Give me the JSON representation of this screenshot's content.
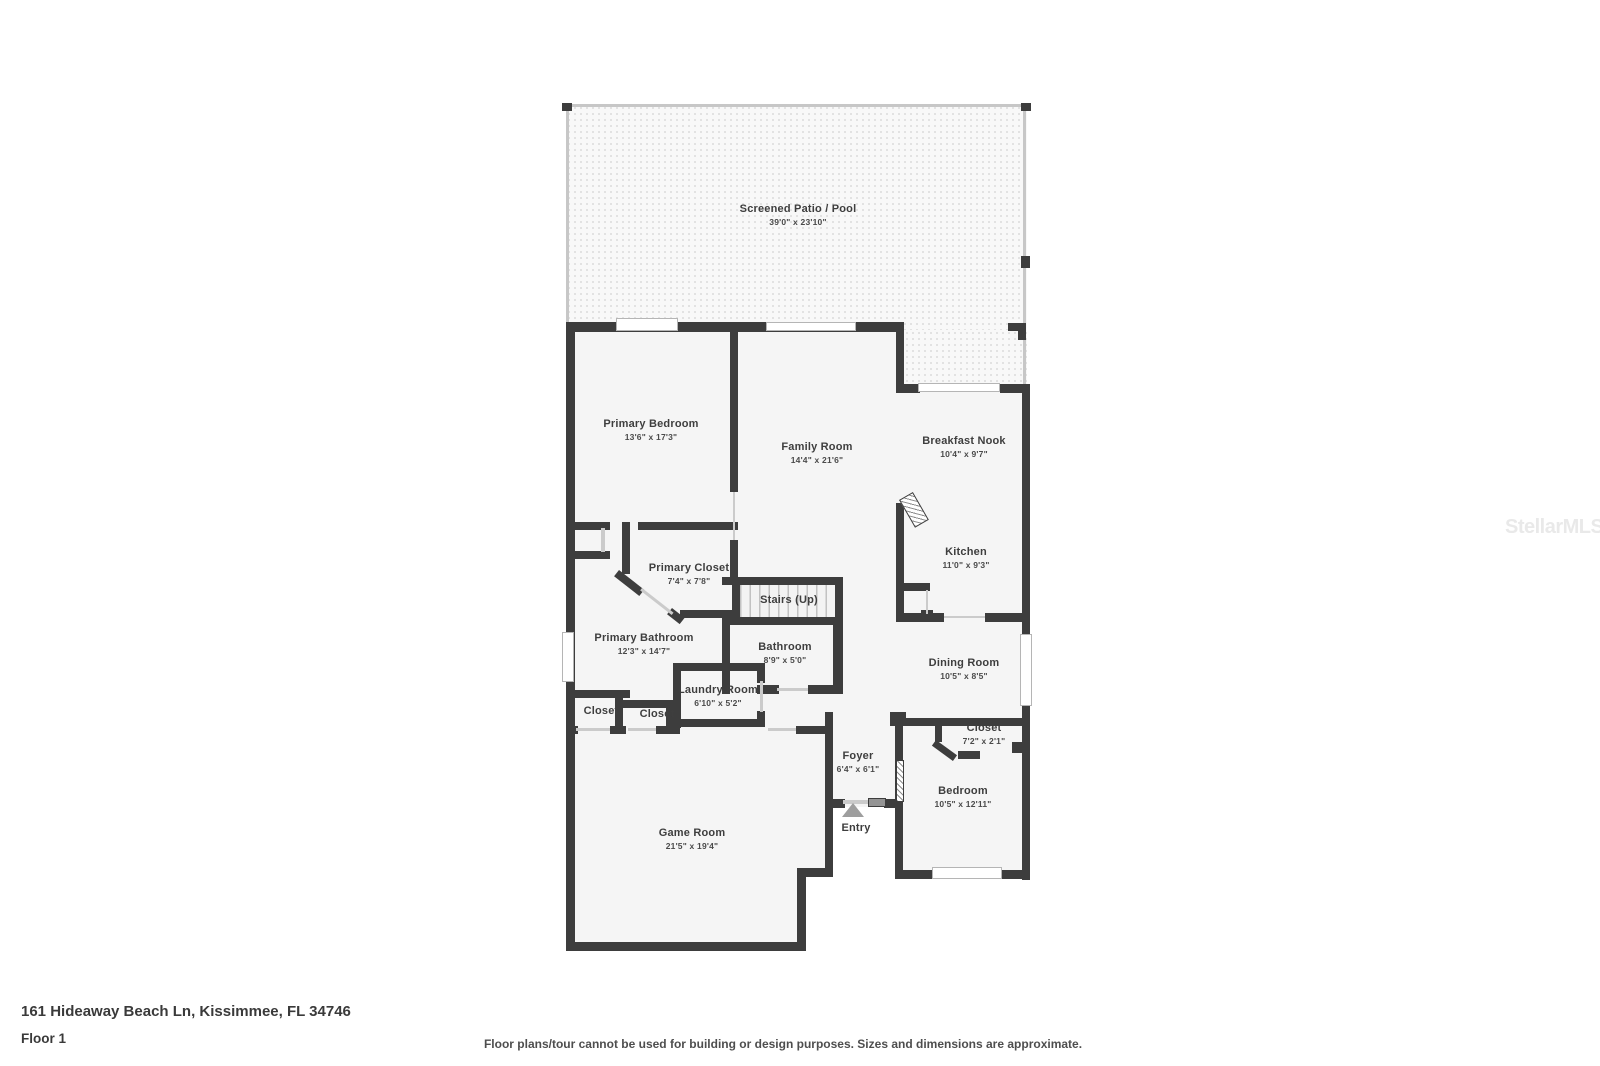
{
  "page": {
    "address": "161 Hideaway Beach Ln, Kissimmee, FL 34746",
    "floor_label": "Floor 1",
    "disclaimer": "Floor plans/tour cannot be used for building or design purposes. Sizes and dimensions are approximate.",
    "watermark": "StellarMLS"
  },
  "colors": {
    "wall": "#3d3d3d",
    "room_fill": "#f5f5f5",
    "patio_fill": "#f8f8f8",
    "window": "#b5b5b5",
    "label_text": "#3e3e3e"
  },
  "rooms": [
    {
      "name": "Screened Patio / Pool",
      "dims": "39'0\" x 23'10\""
    },
    {
      "name": "Primary Bedroom",
      "dims": "13'6\" x 17'3\""
    },
    {
      "name": "Family Room",
      "dims": "14'4\" x 21'6\""
    },
    {
      "name": "Breakfast Nook",
      "dims": "10'4\" x 9'7\""
    },
    {
      "name": "Kitchen",
      "dims": "11'0\" x 9'3\""
    },
    {
      "name": "Primary Closet",
      "dims": "7'4\" x 7'8\""
    },
    {
      "name": "Stairs (Up)",
      "dims": ""
    },
    {
      "name": "Primary Bathroom",
      "dims": "12'3\" x 14'7\""
    },
    {
      "name": "Bathroom",
      "dims": "8'9\" x 5'0\""
    },
    {
      "name": "Dining Room",
      "dims": "10'5\" x 8'5\""
    },
    {
      "name": "Laundry Room",
      "dims": "6'10\" x 5'2\""
    },
    {
      "name": "Closet",
      "dims": ""
    },
    {
      "name": "Closet",
      "dims": ""
    },
    {
      "name": "Closet",
      "dims": "7'2\" x 2'1\""
    },
    {
      "name": "Foyer",
      "dims": "6'4\" x 6'1\""
    },
    {
      "name": "Game Room",
      "dims": "21'5\" x 19'4\""
    },
    {
      "name": "Bedroom",
      "dims": "10'5\" x 12'11\""
    },
    {
      "name": "Entry",
      "dims": ""
    }
  ]
}
